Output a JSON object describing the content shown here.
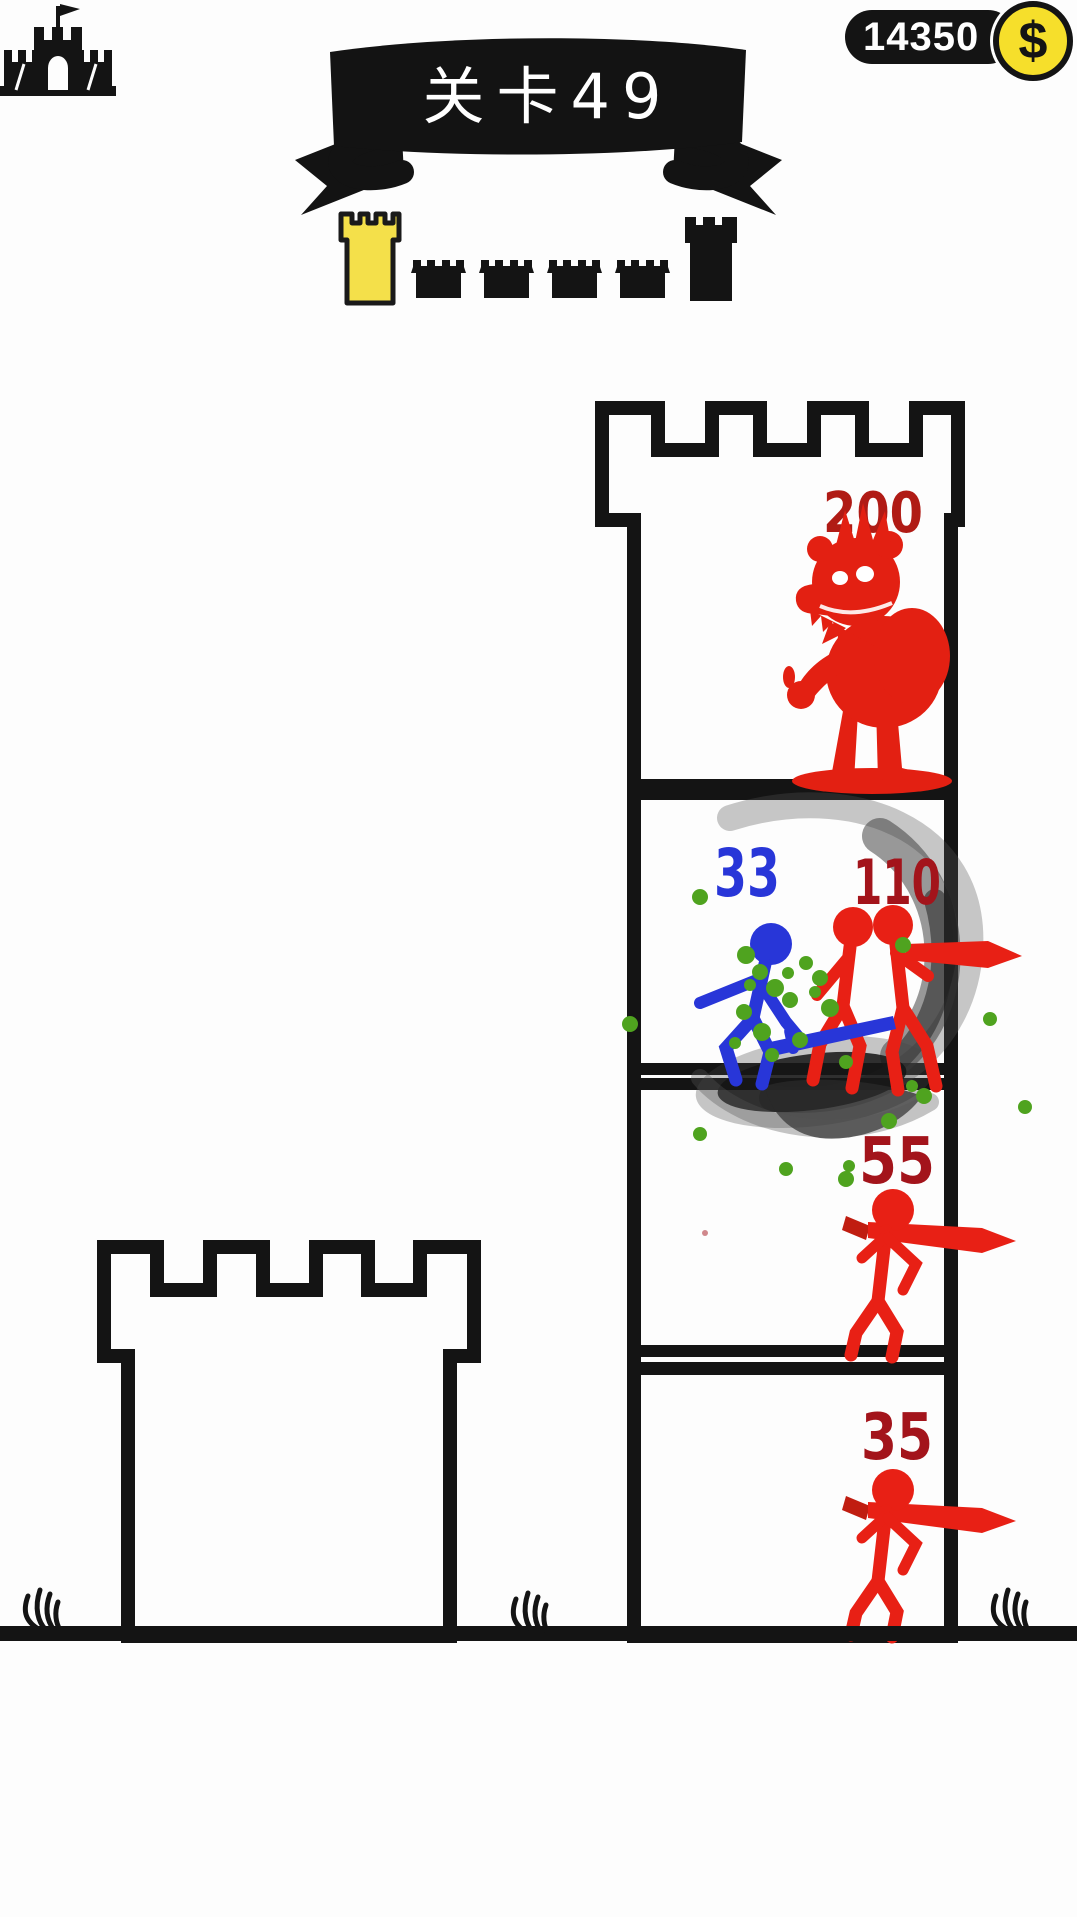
{
  "hud": {
    "level_banner": "关卡49",
    "coins": "14350",
    "currency_symbol": "$"
  },
  "progress": {
    "markers": [
      {
        "type": "current-level-tower",
        "color": "#f4e04a"
      },
      {
        "type": "castle-stage"
      },
      {
        "type": "castle-stage"
      },
      {
        "type": "castle-stage"
      },
      {
        "type": "castle-stage"
      },
      {
        "type": "final-boss-tower",
        "color": "#141414"
      }
    ]
  },
  "battle": {
    "floors": [
      {
        "id": "top-boss-floor",
        "defender": "boss-troll",
        "defender_hp": "200"
      },
      {
        "id": "fight-floor",
        "attacker": "blue-stickman",
        "attacker_hp": "33",
        "defender": "red-swordsmen-pair",
        "defender_hp": "110",
        "effects": [
          "black-smoke-swirl",
          "green-splatter"
        ]
      },
      {
        "id": "third-floor",
        "defender": "red-swordsman",
        "defender_hp": "55"
      },
      {
        "id": "bottom-floor",
        "defender": "red-swordsman",
        "defender_hp": "35"
      }
    ]
  },
  "colors": {
    "ink": "#141414",
    "attacker_blue": "#2836d8",
    "defender_red": "#e82015",
    "hp_text_red": "#a3141b",
    "hp_text_red_bright": "#b01b15",
    "splatter_green": "#4fa31f",
    "gold": "#f6df2b",
    "tower_yellow": "#f4e04a"
  }
}
